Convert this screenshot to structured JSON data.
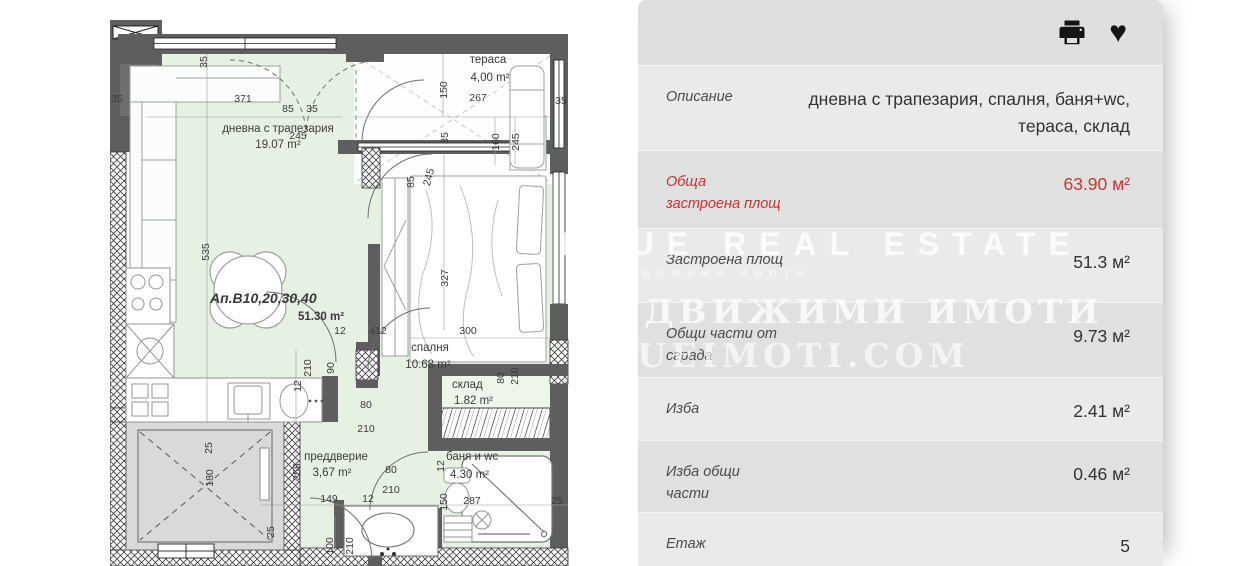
{
  "panel": {
    "icons": [
      {
        "name": "print-icon"
      },
      {
        "name": "heart-icon",
        "glyph": "♥"
      }
    ],
    "rows": [
      {
        "label": "Описание",
        "value": "дневна с трапезария, спалня, баня+wc, тераса, склад"
      },
      {
        "label": "Обща застроена площ",
        "value": "63.90 м²",
        "accent": "#cf312c"
      },
      {
        "label": "Застроена площ",
        "value": "51.3 м²"
      },
      {
        "label": "Общи части от сграда",
        "value": "9.73 м²"
      },
      {
        "label": "Изба",
        "value": "2.41 м²"
      },
      {
        "label": "Изба общи части",
        "value": "0.46 м²"
      },
      {
        "label": "Етаж",
        "value": "5"
      }
    ]
  },
  "floorplan": {
    "apartment_label": "Ап.В10,20,30,40",
    "apartment_area": "51.30 m²",
    "rooms": [
      {
        "name": "дневна с трапезария",
        "area": "19.07 m²"
      },
      {
        "name": "тераса",
        "area": "4,00 m²"
      },
      {
        "name": "спалня",
        "area": "10.68 m²"
      },
      {
        "name": "склад",
        "area": "1.82 m²"
      },
      {
        "name": "баня и wc",
        "area": "4.30 m²"
      },
      {
        "name": "преддверие",
        "area": "3,67 m²"
      }
    ],
    "colors": {
      "wall": "#5e5e5e",
      "floor": "#e6f1e4",
      "elevator": "#d9d9d9"
    },
    "dimensions": [
      "371",
      "35",
      "85",
      "35",
      "245",
      "150",
      "267",
      "160",
      "245",
      "35",
      "35",
      "85",
      "245",
      "35",
      "535",
      "327",
      "300",
      "412",
      "210",
      "90",
      "12",
      "80",
      "210",
      "80",
      "210",
      "12",
      "258",
      "149",
      "12",
      "80",
      "210",
      "25",
      "100",
      "210",
      "25",
      "180",
      "12",
      "150",
      "287",
      "25"
    ]
  },
  "watermark": {
    "line1": "BLUE REAL ESTATE",
    "line2": "НЕДВИЖИМИ ИМОТИ",
    "line3": "НЕДВИЖИМИ ИМОТИ",
    "line4": "BLUEIMOTI.COM"
  }
}
